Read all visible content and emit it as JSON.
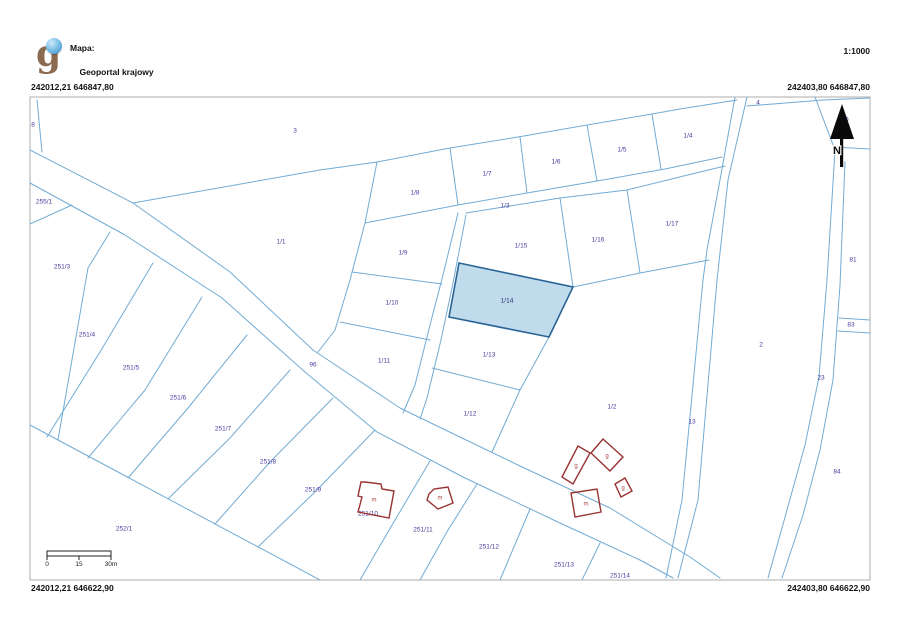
{
  "header": {
    "logo_letter": "g",
    "map_label": "Mapa:",
    "map_name": "Geoportal krajowy",
    "scale": "1:1000"
  },
  "coordinates": {
    "top_left": "242012,21 646847,80",
    "top_right": "242403,80 646847,80",
    "bottom_left": "242012,21 646622,90",
    "bottom_right": "242403,80 646622,90"
  },
  "north_arrow": {
    "label": "N"
  },
  "scale_bar": {
    "labels": [
      "0",
      "15",
      "30m"
    ]
  },
  "map": {
    "colors": {
      "boundary": "#72abd4",
      "label": "#473a9c",
      "highlight_fill": "#c0dcec",
      "highlight_stroke": "#2a6496",
      "building_stroke": "#993333",
      "building_label": "#aa4444",
      "border": "#adadad"
    },
    "highlight_parcel": {
      "id": "1/14",
      "points": "459,263 573,287 549,337 449,317",
      "label": {
        "t": "1/14",
        "x": 507,
        "y": 301
      }
    },
    "boundary_lines": [
      "30,150 133,203 230,272 313,350 400,408 435,425 520,466 610,508 690,557 720,578",
      "30,183 125,235 222,298 305,372 377,432 465,478 560,523 640,560 673,578",
      "133,203 320,170 377,162 450,148 518,137 587,125 652,114 680,109 737,100",
      "37,100 42,152",
      "72,205 30,224",
      "110,232 88,268 58,440",
      "153,263 100,352 47,437",
      "202,297 145,390 88,458",
      "247,335 188,408 128,478",
      "290,370 230,438 168,499",
      "333,398 270,462 215,524",
      "375,430 315,492 258,547",
      "430,461 395,520 360,580",
      "477,484 448,530 420,580",
      "530,509 500,580",
      "600,543 582,580",
      "30,425 320,580",
      "458,213 443,275 430,325 415,385 403,413",
      "466,215 453,283 441,340 427,398 420,419",
      "458,205 527,193 597,181 665,169 722,157",
      "466,213 560,198 627,190 700,172 725,166",
      "450,148 458,205",
      "520,137 527,193",
      "587,125 597,181",
      "652,114 661,169",
      "377,162 365,223",
      "365,223 458,205",
      "365,223 350,280 335,330 318,352",
      "352,272 442,284",
      "340,322 430,340",
      "560,198 573,287",
      "627,190 640,273",
      "573,287 640,273 709,260",
      "432,368 520,390",
      "520,390 492,452",
      "549,337 520,390",
      "735,97 720,180 707,250 703,280 682,500 666,578",
      "747,97 728,180 717,280 698,500 678,578",
      "747,106 823,100 870,98",
      "815,97 835,150",
      "833,147 870,149",
      "835,150 827,280 819,377 805,445 787,510 768,578",
      "845,162 840,285 833,380 820,450 803,515 782,578",
      "839,318 870,320",
      "838,331 870,333"
    ],
    "parcel_labels": [
      {
        "t": "8",
        "x": 33,
        "y": 125
      },
      {
        "t": "3",
        "x": 295,
        "y": 131
      },
      {
        "t": "255/1",
        "x": 44,
        "y": 202
      },
      {
        "t": "251/3",
        "x": 62,
        "y": 267
      },
      {
        "t": "1/1",
        "x": 281,
        "y": 242
      },
      {
        "t": "251/4",
        "x": 87,
        "y": 335
      },
      {
        "t": "251/5",
        "x": 131,
        "y": 368
      },
      {
        "t": "251/6",
        "x": 178,
        "y": 398
      },
      {
        "t": "251/7",
        "x": 223,
        "y": 429
      },
      {
        "t": "96",
        "x": 313,
        "y": 365
      },
      {
        "t": "251/8",
        "x": 268,
        "y": 462
      },
      {
        "t": "251/9",
        "x": 313,
        "y": 490
      },
      {
        "t": "252/1",
        "x": 124,
        "y": 529
      },
      {
        "t": "251/10",
        "x": 368,
        "y": 514
      },
      {
        "t": "251/11",
        "x": 423,
        "y": 530
      },
      {
        "t": "251/12",
        "x": 489,
        "y": 547
      },
      {
        "t": "251/13",
        "x": 564,
        "y": 565
      },
      {
        "t": "251/14",
        "x": 620,
        "y": 576
      },
      {
        "t": "1/8",
        "x": 415,
        "y": 193
      },
      {
        "t": "1/7",
        "x": 487,
        "y": 174
      },
      {
        "t": "1/6",
        "x": 556,
        "y": 162
      },
      {
        "t": "1/5",
        "x": 622,
        "y": 150
      },
      {
        "t": "1/4",
        "x": 688,
        "y": 136
      },
      {
        "t": "1/3",
        "x": 505,
        "y": 206
      },
      {
        "t": "4",
        "x": 758,
        "y": 103
      },
      {
        "t": "1/15",
        "x": 521,
        "y": 246
      },
      {
        "t": "1/16",
        "x": 598,
        "y": 240
      },
      {
        "t": "1/17",
        "x": 672,
        "y": 224
      },
      {
        "t": "1/9",
        "x": 403,
        "y": 253
      },
      {
        "t": "1/10",
        "x": 392,
        "y": 303
      },
      {
        "t": "1/11",
        "x": 384,
        "y": 361
      },
      {
        "t": "1/13",
        "x": 489,
        "y": 355
      },
      {
        "t": "1/12",
        "x": 470,
        "y": 414
      },
      {
        "t": "1/2",
        "x": 612,
        "y": 407
      },
      {
        "t": "2",
        "x": 761,
        "y": 345
      },
      {
        "t": "13",
        "x": 692,
        "y": 422
      },
      {
        "t": "23",
        "x": 821,
        "y": 378
      },
      {
        "t": "81",
        "x": 853,
        "y": 260
      },
      {
        "t": "83",
        "x": 851,
        "y": 325
      },
      {
        "t": "84",
        "x": 837,
        "y": 472
      },
      {
        "t": "80",
        "x": 845,
        "y": 120
      }
    ],
    "buildings": [
      {
        "points": "365,482 381,484 382,489 394,491 389,518 358,512 362,497 358,496 361,482",
        "label": {
          "t": "m",
          "x": 374,
          "y": 500
        }
      },
      {
        "points": "429,494 434,489 448,487 453,503 438,509 427,500",
        "label": {
          "t": "m",
          "x": 440,
          "y": 498
        }
      },
      {
        "points": "562,477 578,446 590,453 573,484",
        "label": {
          "t": "g",
          "x": 576,
          "y": 466
        }
      },
      {
        "points": "591,453 603,439 623,457 610,471",
        "label": {
          "t": "g",
          "x": 607,
          "y": 456
        }
      },
      {
        "points": "615,484 625,478 632,491 621,497",
        "label": {
          "t": "g",
          "x": 623,
          "y": 488
        }
      },
      {
        "points": "571,493 597,489 601,512 575,517",
        "label": {
          "t": "m",
          "x": 586,
          "y": 504
        }
      }
    ]
  }
}
